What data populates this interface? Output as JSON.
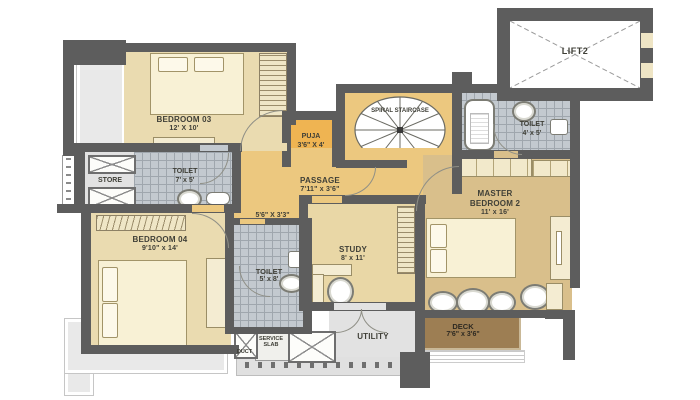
{
  "title": "Apartment Floor Plan",
  "colors": {
    "wall": "#5d5d5d",
    "bedroom_floor": "#eadbb0",
    "passage_gold": "#ecc87f",
    "puja_gold": "#efb452",
    "master_tan": "#d9bf8b",
    "study_tan": "#e9d7a6",
    "tile_gray": "#c3c9cf",
    "deck_brown": "#9d7e53",
    "utility_gray": "#e2e2e2"
  },
  "rooms": {
    "bedroom03": {
      "label": "BEDROOM 03",
      "dims": "12' X 10'"
    },
    "store": {
      "label": "STORE"
    },
    "toilet_top": {
      "label": "TOILET",
      "dims": "7' x 5'"
    },
    "puja": {
      "label": "PUJA",
      "dims": "3'6\" X 4'"
    },
    "spiral_staircase": {
      "label": "SPIRAL STAIRCASE"
    },
    "lift": {
      "label": "LIFT2"
    },
    "toilet_master": {
      "label": "TOILET",
      "dims": "4' x 5'"
    },
    "passage": {
      "label": "PASSAGE",
      "dims": "7'11\" x 3'6\""
    },
    "inner_passage": {
      "dims": "5'6\" X 3'3\""
    },
    "bedroom04": {
      "label": "BEDROOM 04",
      "dims": "9'10\" x 14'"
    },
    "toilet_mid": {
      "label": "TOILET",
      "dims": "5' x 8'"
    },
    "study": {
      "label": "STUDY",
      "dims": "8' x 11'"
    },
    "master_bedroom": {
      "label": "MASTER BEDROOM 2",
      "dims": "11' x 16'"
    },
    "deck": {
      "label": "DECK",
      "dims": "7'6\" x 3'6\""
    },
    "utility": {
      "label": "UTILITY"
    },
    "service_slab": {
      "label": "SERVICE SLAB"
    },
    "duct": {
      "label": "DUCT"
    }
  }
}
